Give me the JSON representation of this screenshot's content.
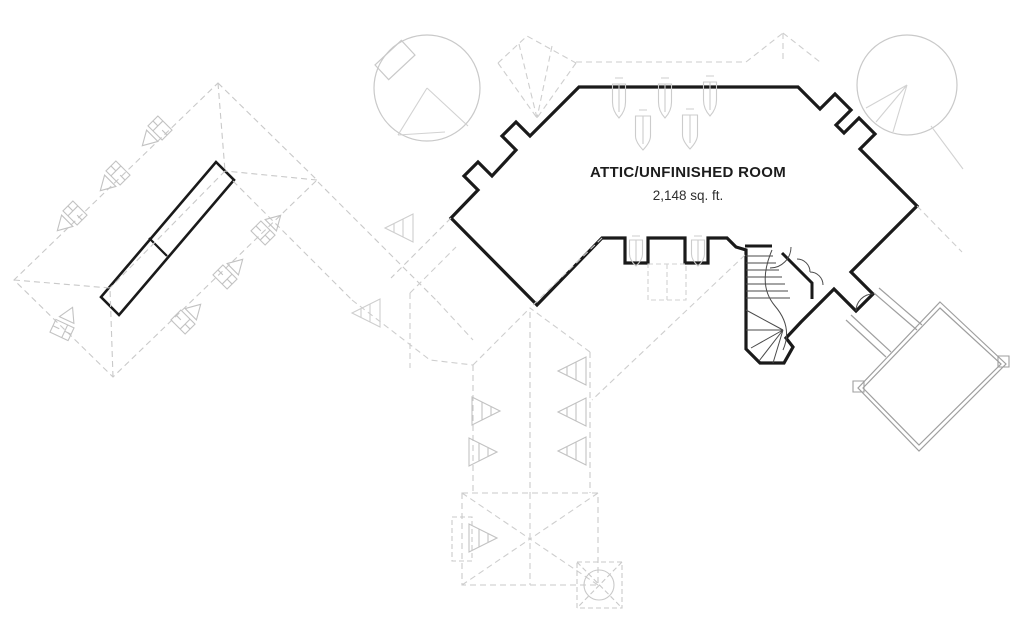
{
  "title": "Attic floor plan",
  "labels": {
    "room_label": "ATTIC/UNFINISHED ROOM",
    "room_area": "2,148 sq. ft."
  },
  "colors": {
    "background": "#ffffff",
    "bold_wall": "#1a1a1a",
    "stair_line": "#4a4a4a",
    "lower_wall": "#9f9f9f",
    "roof_line": "#c9c9c9",
    "symbol_line": "#c2c2c2",
    "text": "#1c1c1c"
  },
  "floor_plan": {
    "shapes": [
      {
        "name": "attic-room-outline",
        "tag": "path",
        "attrs": {
          "d": "M579,87 L798,87 L820,109 L835,94 L851,110 L836,125 L844,133 L859,118 L875,134 L860,149 L917,206 L851,272 L873,294 L856,311 L834,289 L801,322 L786,338 L793,347 L784,363 L760,363 L746,349 L746,250 L736,247 L727,238 L708,238 L708,263 L685,263 L685,238 L648,238 L648,263 L625,263 L625,238 L602,238 L537,305 L451,218 L478,190 L464,176 L478,162 L492,176 L516,150 L502,136 L516,122 L530,136 Z",
          "fill": "none",
          "stroke": "#1a1a1a",
          "stroke-width": "3.2",
          "stroke-linejoin": "miter"
        }
      },
      {
        "name": "stairwell-top-wall",
        "tag": "path",
        "attrs": {
          "d": "M745,246 L772,246 M782,253 L812,283 L812,299",
          "fill": "none",
          "stroke": "#1a1a1a",
          "stroke-width": "3"
        }
      },
      {
        "name": "ridge-skylight-strip",
        "tag": "path",
        "attrs": {
          "d": "M216,162 L234,180 L119,315 L101,297 Z",
          "fill": "none",
          "stroke": "#1a1a1a",
          "stroke-width": "2.6"
        }
      },
      {
        "name": "ridge-skylight-divider",
        "tag": "path",
        "attrs": {
          "d": "M149,238 L167,256",
          "fill": "none",
          "stroke": "#1a1a1a",
          "stroke-width": "2.2"
        }
      },
      {
        "name": "stair-treads-upper",
        "tag": "path",
        "attrs": {
          "d": "M746,256 L773,256 M746,263 L776,263 M746,270 L779,270 M746,277 L782,277 M746,284 L785,284 M746,291 L788,291 M746,298 L790,298",
          "fill": "none",
          "stroke": "#4a4a4a",
          "stroke-width": "1"
        }
      },
      {
        "name": "stair-treads-fan",
        "tag": "path",
        "attrs": {
          "d": "M783,330 L746,310 M783,330 L746,330 M783,330 L751,348 M783,330 L759,361 M783,330 L773,363",
          "fill": "none",
          "stroke": "#4a4a4a",
          "stroke-width": "1"
        }
      },
      {
        "name": "stair-winder-curb",
        "tag": "path",
        "attrs": {
          "d": "M772,250 Q757,285 775,306 Q793,327 783,350",
          "fill": "none",
          "stroke": "#4a4a4a",
          "stroke-width": "1"
        }
      },
      {
        "name": "stair-door-swing-arc",
        "tag": "path",
        "attrs": {
          "d": "M791,247 A21,21 0 0 1 770,268",
          "fill": "none",
          "stroke": "#4a4a4a",
          "stroke-width": "1"
        }
      },
      {
        "name": "closet-door-arcs",
        "tag": "path",
        "attrs": {
          "d": "M797,259 A13,13 0 0 1 810,272 M810,272 A13,13 0 0 1 823,285",
          "fill": "none",
          "stroke": "#4a4a4a",
          "stroke-width": "1"
        }
      },
      {
        "name": "breezeway-door-arc",
        "tag": "path",
        "attrs": {
          "d": "M856,311 A17,17 0 0 1 873,294",
          "fill": "none",
          "stroke": "#4a4a4a",
          "stroke-width": "1"
        }
      },
      {
        "name": "garage-wall-outer",
        "tag": "path",
        "attrs": {
          "d": "M940,302 L1006,364 L919,451 L858,388 Z",
          "fill": "none",
          "stroke": "#9f9f9f",
          "stroke-width": "1.2"
        }
      },
      {
        "name": "garage-wall-inner",
        "tag": "path",
        "attrs": {
          "d": "M940,308 L1001,364 L919,445 L863,388 Z",
          "fill": "none",
          "stroke": "#9f9f9f",
          "stroke-width": "1.2"
        }
      },
      {
        "name": "garage-corner-pads",
        "tag": "path",
        "attrs": {
          "d": "M853,381 h11 v11 h-11 Z M998,356 h11 v11 h-11 Z",
          "fill": "none",
          "stroke": "#9f9f9f",
          "stroke-width": "1.1"
        }
      },
      {
        "name": "breezeway-walls",
        "tag": "path",
        "attrs": {
          "d": "M874,293 L917,330 M879,288 L922,325 M846,320 L886,357 M851,315 L891,352",
          "fill": "none",
          "stroke": "#9f9f9f",
          "stroke-width": "1.2"
        }
      },
      {
        "name": "left-roof-outline",
        "tag": "path",
        "attrs": {
          "d": "M218,83 L317,180 L113,377 L14,280 Z",
          "fill": "none",
          "stroke": "#c9c9c9",
          "stroke-width": "1.1",
          "stroke-dasharray": "6,4"
        }
      },
      {
        "name": "left-roof-hips",
        "tag": "path",
        "attrs": {
          "d": "M218,83 L225,171 M317,180 L225,171 M113,377 L110,288 M14,280 L110,288 M225,171 L110,288",
          "fill": "none",
          "stroke": "#c9c9c9",
          "stroke-width": "1.1",
          "stroke-dasharray": "6,4"
        }
      },
      {
        "name": "connector-eave-lines",
        "tag": "path",
        "attrs": {
          "d": "M233,181 L352,300 M318,182 L437,301 M451,218 L391,278",
          "fill": "none",
          "stroke": "#c9c9c9",
          "stroke-width": "1.1",
          "stroke-dasharray": "6,4"
        }
      },
      {
        "name": "central-roof-valleys",
        "tag": "path",
        "attrs": {
          "d": "M352,300 L430,360 L473,365 M437,301 L473,340 M602,238 L530,308 M473,365 L530,308 M590,352 L530,308 M410,293 L410,368 M410,293 L456,247 M745,255 L592,400 M917,206 L962,252",
          "fill": "none",
          "stroke": "#cecece",
          "stroke-width": "1.1",
          "stroke-dasharray": "6,4"
        }
      },
      {
        "name": "corridor-eaves",
        "tag": "path",
        "attrs": {
          "d": "M473,365 L473,493 M590,352 L590,493 M530,312 L530,493",
          "fill": "none",
          "stroke": "#c9c9c9",
          "stroke-width": "1.1",
          "stroke-dasharray": "6,4"
        }
      },
      {
        "name": "bottom-roof-outline",
        "tag": "path",
        "attrs": {
          "d": "M462,493 L598,493 L598,585 L462,585 Z",
          "fill": "none",
          "stroke": "#c9c9c9",
          "stroke-width": "1.1",
          "stroke-dasharray": "6,4"
        }
      },
      {
        "name": "bottom-roof-hips",
        "tag": "path",
        "attrs": {
          "d": "M462,493 L530,539 M598,493 L530,539 M462,585 L530,539 M598,585 L530,539 M530,493 L530,585",
          "fill": "none",
          "stroke": "#cecece",
          "stroke-width": "1.1",
          "stroke-dasharray": "6,4"
        }
      },
      {
        "name": "bottom-bumpout",
        "tag": "path",
        "attrs": {
          "d": "M452,517 h20 v44 h-20 Z",
          "fill": "none",
          "stroke": "#c9c9c9",
          "stroke-width": "1.1",
          "stroke-dasharray": "5,3"
        }
      },
      {
        "name": "spa-square",
        "tag": "path",
        "attrs": {
          "d": "M577,562 h45 v46 h-45 Z M577,562 L622,608 M622,562 L577,608",
          "fill": "none",
          "stroke": "#c9c9c9",
          "stroke-width": "1.1",
          "stroke-dasharray": "5,3"
        }
      },
      {
        "name": "spa-circle",
        "tag": "circle",
        "attrs": {
          "cx": "599",
          "cy": "585",
          "r": "15",
          "fill": "none",
          "stroke": "#c9c9c9",
          "stroke-width": "1.1"
        }
      },
      {
        "name": "top-eave-lines",
        "tag": "path",
        "attrs": {
          "d": "M576,62 L746,62 M746,62 L783,33 M783,33 L820,62 M783,33 L783,62",
          "fill": "none",
          "stroke": "#cecece",
          "stroke-width": "1.1",
          "stroke-dasharray": "6,4"
        }
      },
      {
        "name": "turret-gable-fan",
        "tag": "path",
        "attrs": {
          "d": "M498,63 L527,36 L576,63 M498,63 L537,118 M519,44 L537,118 M552,46 L537,118 M576,63 L537,118",
          "fill": "none",
          "stroke": "#cecece",
          "stroke-width": "1.1",
          "stroke-dasharray": "6,4"
        }
      },
      {
        "name": "notch-skylight-box",
        "tag": "path",
        "attrs": {
          "d": "M648,264 h38 v36 h-38 Z M667,264 v36",
          "fill": "none",
          "stroke": "#d2d2d2",
          "stroke-width": "1.1",
          "stroke-dasharray": "5,3"
        }
      },
      {
        "name": "turret-left-circle",
        "tag": "circle",
        "attrs": {
          "cx": "427",
          "cy": "88",
          "r": "53",
          "fill": "none",
          "stroke": "#c9c9c9",
          "stroke-width": "1.2"
        }
      },
      {
        "name": "turret-left-lines",
        "tag": "path",
        "attrs": {
          "d": "M427,88 L468,126 M427,88 L398,135 M398,135 L445,132",
          "fill": "none",
          "stroke": "#d2d2d2",
          "stroke-width": "1.1"
        }
      },
      {
        "name": "turret-left-dormer",
        "tag": "path",
        "attrs": {
          "d": "M-18,-10 h36 v20 h-36 Z",
          "transform": "translate(395,60) rotate(-43)",
          "fill": "none",
          "stroke": "#c9c9c9",
          "stroke-width": "1.2"
        }
      },
      {
        "name": "turret-right-circle",
        "tag": "circle",
        "attrs": {
          "cx": "907",
          "cy": "85",
          "r": "50",
          "fill": "none",
          "stroke": "#c9c9c9",
          "stroke-width": "1.2"
        }
      },
      {
        "name": "turret-right-rays",
        "tag": "path",
        "attrs": {
          "d": "M907,85 L866,108 M907,85 L876,122 M907,85 L893,132 M931,126 L963,169",
          "fill": "none",
          "stroke": "#d2d2d2",
          "stroke-width": "1.1"
        }
      },
      {
        "name": "roof-vent-1",
        "tag": "path",
        "attrs": {
          "d": "M-10,-7 h20 v14 h-20 Z M-3,-7 v14 M-10,0 h7 M3,0 h7 M-8,11 L0,25 L8,11 Z",
          "transform": "translate(160,128) rotate(45)",
          "fill": "none",
          "stroke": "#c2c2c2",
          "stroke-width": "1.1"
        }
      },
      {
        "name": "roof-vent-2",
        "tag": "path",
        "attrs": {
          "d": "M-10,-7 h20 v14 h-20 Z M-3,-7 v14 M-10,0 h7 M3,0 h7 M-8,11 L0,25 L8,11 Z",
          "transform": "translate(118,173) rotate(45)",
          "fill": "none",
          "stroke": "#c2c2c2",
          "stroke-width": "1.1"
        }
      },
      {
        "name": "roof-vent-3",
        "tag": "path",
        "attrs": {
          "d": "M-10,-7 h20 v14 h-20 Z M-3,-7 v14 M-10,0 h7 M3,0 h7 M-8,11 L0,25 L8,11 Z",
          "transform": "translate(75,213) rotate(45)",
          "fill": "none",
          "stroke": "#c2c2c2",
          "stroke-width": "1.1"
        }
      },
      {
        "name": "roof-vent-4",
        "tag": "path",
        "attrs": {
          "d": "M-10,-7 h20 v14 h-20 Z M-3,-7 v14 M-10,0 h7 M3,0 h7 M-8,11 L0,25 L8,11 Z",
          "transform": "translate(263,233) rotate(225)",
          "fill": "none",
          "stroke": "#c2c2c2",
          "stroke-width": "1.1"
        }
      },
      {
        "name": "roof-vent-5",
        "tag": "path",
        "attrs": {
          "d": "M-10,-7 h20 v14 h-20 Z M-3,-7 v14 M-10,0 h7 M3,0 h7 M-8,11 L0,25 L8,11 Z",
          "transform": "translate(225,277) rotate(225)",
          "fill": "none",
          "stroke": "#c2c2c2",
          "stroke-width": "1.1"
        }
      },
      {
        "name": "roof-vent-6",
        "tag": "path",
        "attrs": {
          "d": "M-10,-7 h20 v14 h-20 Z M-3,-7 v14 M-10,0 h7 M3,0 h7 M-8,11 L0,25 L8,11 Z",
          "transform": "translate(183,322) rotate(225)",
          "fill": "none",
          "stroke": "#c2c2c2",
          "stroke-width": "1.1"
        }
      },
      {
        "name": "roof-vent-7",
        "tag": "path",
        "attrs": {
          "d": "M-10,-7 h20 v14 h-20 Z M-3,-7 v14 M-10,0 h7 M3,0 h7 M-8,11 L0,25 L8,11 Z",
          "transform": "translate(62,330) rotate(205)",
          "fill": "none",
          "stroke": "#c2c2c2",
          "stroke-width": "1.1"
        }
      },
      {
        "name": "gable-vent-tree-1",
        "tag": "path",
        "attrs": {
          "d": "M0,0 L28,-14 L28,14 Z M9,-4.5 L9,4.5 M18,-9 L18,9",
          "transform": "translate(500,411) rotate(180)",
          "fill": "none",
          "stroke": "#c2c2c2",
          "stroke-width": "1.1"
        }
      },
      {
        "name": "gable-vent-tree-2",
        "tag": "path",
        "attrs": {
          "d": "M0,0 L28,-14 L28,14 Z M9,-4.5 L9,4.5 M18,-9 L18,9",
          "transform": "translate(497,452) rotate(180)",
          "fill": "none",
          "stroke": "#c2c2c2",
          "stroke-width": "1.1"
        }
      },
      {
        "name": "gable-vent-tree-3",
        "tag": "path",
        "attrs": {
          "d": "M0,0 L28,-14 L28,14 Z M9,-4.5 L9,4.5 M18,-9 L18,9",
          "transform": "translate(558,371)",
          "fill": "none",
          "stroke": "#c2c2c2",
          "stroke-width": "1.1"
        }
      },
      {
        "name": "gable-vent-tree-4",
        "tag": "path",
        "attrs": {
          "d": "M0,0 L28,-14 L28,14 Z M9,-4.5 L9,4.5 M18,-9 L18,9",
          "transform": "translate(558,412)",
          "fill": "none",
          "stroke": "#c2c2c2",
          "stroke-width": "1.1"
        }
      },
      {
        "name": "gable-vent-tree-5",
        "tag": "path",
        "attrs": {
          "d": "M0,0 L28,-14 L28,14 Z M9,-4.5 L9,4.5 M18,-9 L18,9",
          "transform": "translate(558,451)",
          "fill": "none",
          "stroke": "#c2c2c2",
          "stroke-width": "1.1"
        }
      },
      {
        "name": "gable-vent-tree-6",
        "tag": "path",
        "attrs": {
          "d": "M0,0 L28,-14 L28,14 Z M9,-4.5 L9,4.5 M18,-9 L18,9",
          "transform": "translate(497,538) rotate(180)",
          "fill": "none",
          "stroke": "#c2c2c2",
          "stroke-width": "1.1"
        }
      },
      {
        "name": "gable-vent-tree-7",
        "tag": "path",
        "attrs": {
          "d": "M0,0 L28,-14 L28,14 Z M9,-4.5 L9,4.5 M18,-9 L18,9",
          "transform": "translate(385,228)",
          "fill": "none",
          "stroke": "#cecece",
          "stroke-width": "1.1"
        }
      },
      {
        "name": "gable-vent-tree-8",
        "tag": "path",
        "attrs": {
          "d": "M0,0 L28,-14 L28,14 Z M9,-4.5 L9,4.5 M18,-9 L18,9",
          "transform": "translate(352,313)",
          "fill": "none",
          "stroke": "#cecece",
          "stroke-width": "1.1"
        }
      },
      {
        "name": "attic-window-1",
        "tag": "path",
        "attrs": {
          "d": "M-4,-40 L4,-40 M-6.5,-34 L6.5,-34 L6.5,-16 Q6.5,-7 0,0 Q-6.5,-7 -6.5,-16 Z M0,-34 L0,-6",
          "transform": "translate(619,118)",
          "fill": "none",
          "stroke": "#cccccc",
          "stroke-width": "1.1"
        }
      },
      {
        "name": "attic-window-2",
        "tag": "path",
        "attrs": {
          "d": "M-4,-40 L4,-40 M-6.5,-34 L6.5,-34 L6.5,-16 Q6.5,-7 0,0 Q-6.5,-7 -6.5,-16 Z M0,-34 L0,-6",
          "transform": "translate(665,118)",
          "fill": "none",
          "stroke": "#cccccc",
          "stroke-width": "1.1"
        }
      },
      {
        "name": "attic-window-3",
        "tag": "path",
        "attrs": {
          "d": "M-4,-40 L4,-40 M-6.5,-34 L6.5,-34 L6.5,-16 Q6.5,-7 0,0 Q-6.5,-7 -6.5,-16 Z M0,-34 L0,-6",
          "transform": "translate(710,116)",
          "fill": "none",
          "stroke": "#cccccc",
          "stroke-width": "1.1"
        }
      },
      {
        "name": "attic-window-4",
        "tag": "path",
        "attrs": {
          "d": "M-4,-40 L4,-40 M-7.5,-34 L7.5,-34 L7.5,-14 Q7.5,-8 0,0 Q-7.5,-8 -7.5,-14 Z M0,-34 L0,-6",
          "transform": "translate(643,150)",
          "fill": "none",
          "stroke": "#cccccc",
          "stroke-width": "1.1"
        }
      },
      {
        "name": "attic-window-5",
        "tag": "path",
        "attrs": {
          "d": "M-4,-40 L4,-40 M-7.5,-34 L7.5,-34 L7.5,-14 Q7.5,-8 0,0 Q-7.5,-8 -7.5,-14 Z M0,-34 L0,-6",
          "transform": "translate(690,149)",
          "fill": "none",
          "stroke": "#cccccc",
          "stroke-width": "1.1"
        }
      },
      {
        "name": "attic-window-6",
        "tag": "path",
        "attrs": {
          "d": "M-4,-30 L4,-30 M-6.5,-26 L6.5,-26 L6.5,-12 Q6.5,-6 0,0 Q-6.5,-6 -6.5,-12 Z M0,-26 L0,-5",
          "transform": "translate(636,266)",
          "fill": "none",
          "stroke": "#cccccc",
          "stroke-width": "1.1"
        }
      },
      {
        "name": "attic-window-7",
        "tag": "path",
        "attrs": {
          "d": "M-4,-30 L4,-30 M-6.5,-26 L6.5,-26 L6.5,-12 Q6.5,-6 0,0 Q-6.5,-6 -6.5,-12 Z M0,-26 L0,-5",
          "transform": "translate(698,266)",
          "fill": "none",
          "stroke": "#cccccc",
          "stroke-width": "1.1"
        }
      }
    ]
  }
}
